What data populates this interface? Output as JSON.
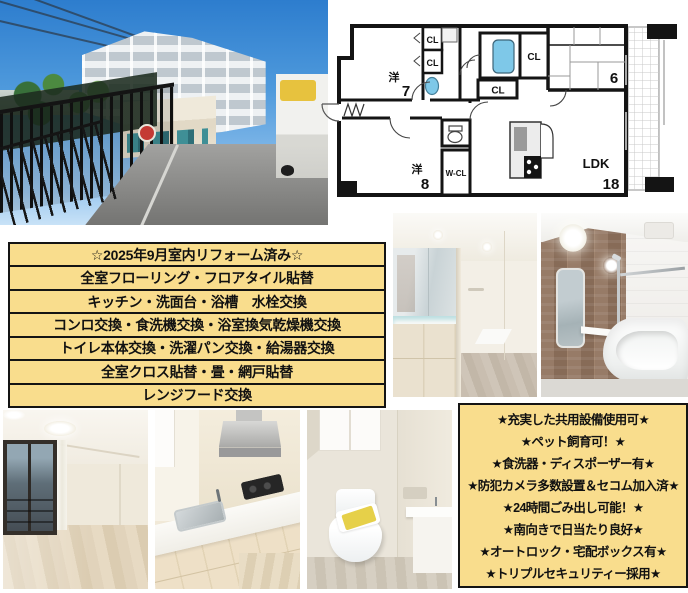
{
  "canvas": {
    "background": "#ffffff"
  },
  "renovation_table": {
    "bg_color": "#F9DD8D",
    "border_color": "#141414",
    "rows": [
      "☆2025年9月室内リフォーム済み☆",
      "全室フローリング・フロアタイル貼替",
      "キッチン・洗面台・浴槽　水栓交換",
      "コンロ交換・食洗機交換・浴室換気乾燥機交換",
      "トイレ本体交換・洗濯パン交換・給湯器交換",
      "全室クロス貼替・畳・網戸貼替",
      "レンジフード交換"
    ]
  },
  "features_box": {
    "bg_color": "#F9DD8D",
    "border_color": "#141414",
    "lines": [
      "★充実した共用設備使用可★",
      "★ペット飼育可！★",
      "★食洗器・ディスポーザー有★",
      "★防犯カメラ多数設置＆セコム加入済★",
      "★24時間ごみ出し可能！★",
      "★南向きで日当たり良好★",
      "★オートロック・宅配ボックス有★",
      "★トリプルセキュリティー採用★"
    ]
  },
  "floorplan": {
    "wall_color": "#141414",
    "water_fixture_color": "#7EC8E8",
    "labels": {
      "closet": "CL",
      "walkin_closet": "W-CL",
      "western7_kanji": "洋",
      "western7_size": "7",
      "western8_kanji": "洋",
      "western8_size": "8",
      "tatami_size": "6",
      "ldk": "LDK",
      "ldk_size": "18"
    }
  }
}
